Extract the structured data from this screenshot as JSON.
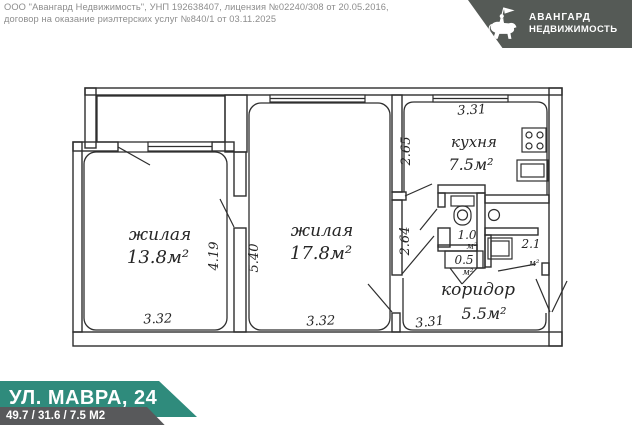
{
  "header": {
    "line1": "ООО \"Авангард Недвижимость\", УНП 192638407, лицензия №02240/308 от 20.05.2016,",
    "line2": "договор на оказание риэлтерских услуг №840/1 от 03.11.2025"
  },
  "logo": {
    "line1": "АВАНГАРД",
    "line2": "НЕДВИЖИМОСТЬ"
  },
  "plan": {
    "room1": {
      "label": "жилая",
      "area": "13.8м²",
      "dim_bottom": "3.32",
      "dim_right": "4.19"
    },
    "room2": {
      "label": "жилая",
      "area": "17.8м²",
      "dim_bottom": "3.32",
      "dim_left": "5.40"
    },
    "kitchen": {
      "label": "кухня",
      "area": "7.5м²",
      "dim_top": "3.31",
      "dim_left": "2.65"
    },
    "corridor": {
      "label": "коридор",
      "area": "5.5м²",
      "dim_bottom": "3.31",
      "dim_left": "2.64"
    },
    "wc": {
      "area": "1.0",
      "unit": "м²"
    },
    "storage": {
      "area": "0.5",
      "unit": "м²"
    },
    "bath": {
      "area": "2.1",
      "unit": "м²"
    }
  },
  "footer": {
    "address": "УЛ. МАВРА, 24",
    "areas": "49.7 / 31.6 / 7.5 М2"
  },
  "colors": {
    "accent_teal": "#2F8B7C",
    "logo_bg": "#555A56",
    "strip_gray": "#58595B",
    "line": "#2E2E2E"
  }
}
